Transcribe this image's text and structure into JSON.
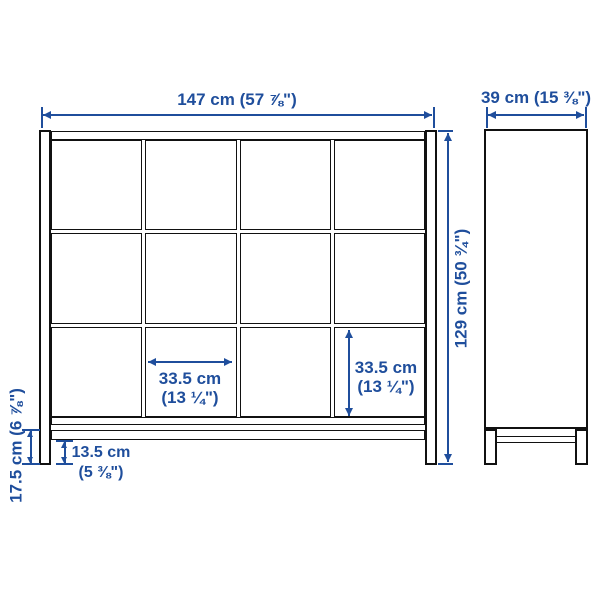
{
  "drawing": {
    "type": "furniture-dimension-diagram",
    "product": "cube shelving unit with underframe, 4x3 grid",
    "colors": {
      "background": "#ffffff",
      "furniture_line": "#111111",
      "dimension": "#1f4e9c"
    },
    "grid": {
      "columns": 4,
      "rows": 3
    },
    "labels": {
      "front_width": "147 cm (57 ⅞\")",
      "side_depth": "39 cm (15 ⅜\")",
      "total_height": "129 cm (50 ¾\")",
      "cell_width_cm": "33.5 cm",
      "cell_width_in": "(13 ¼\")",
      "cell_height_cm": "33.5 cm",
      "cell_height_in": "(13 ¼\")",
      "rail_clearance_cm": "13.5 cm",
      "rail_clearance_in": "(5 ⅜\")",
      "base_height": "17.5 cm (6 ⅞\")"
    }
  }
}
